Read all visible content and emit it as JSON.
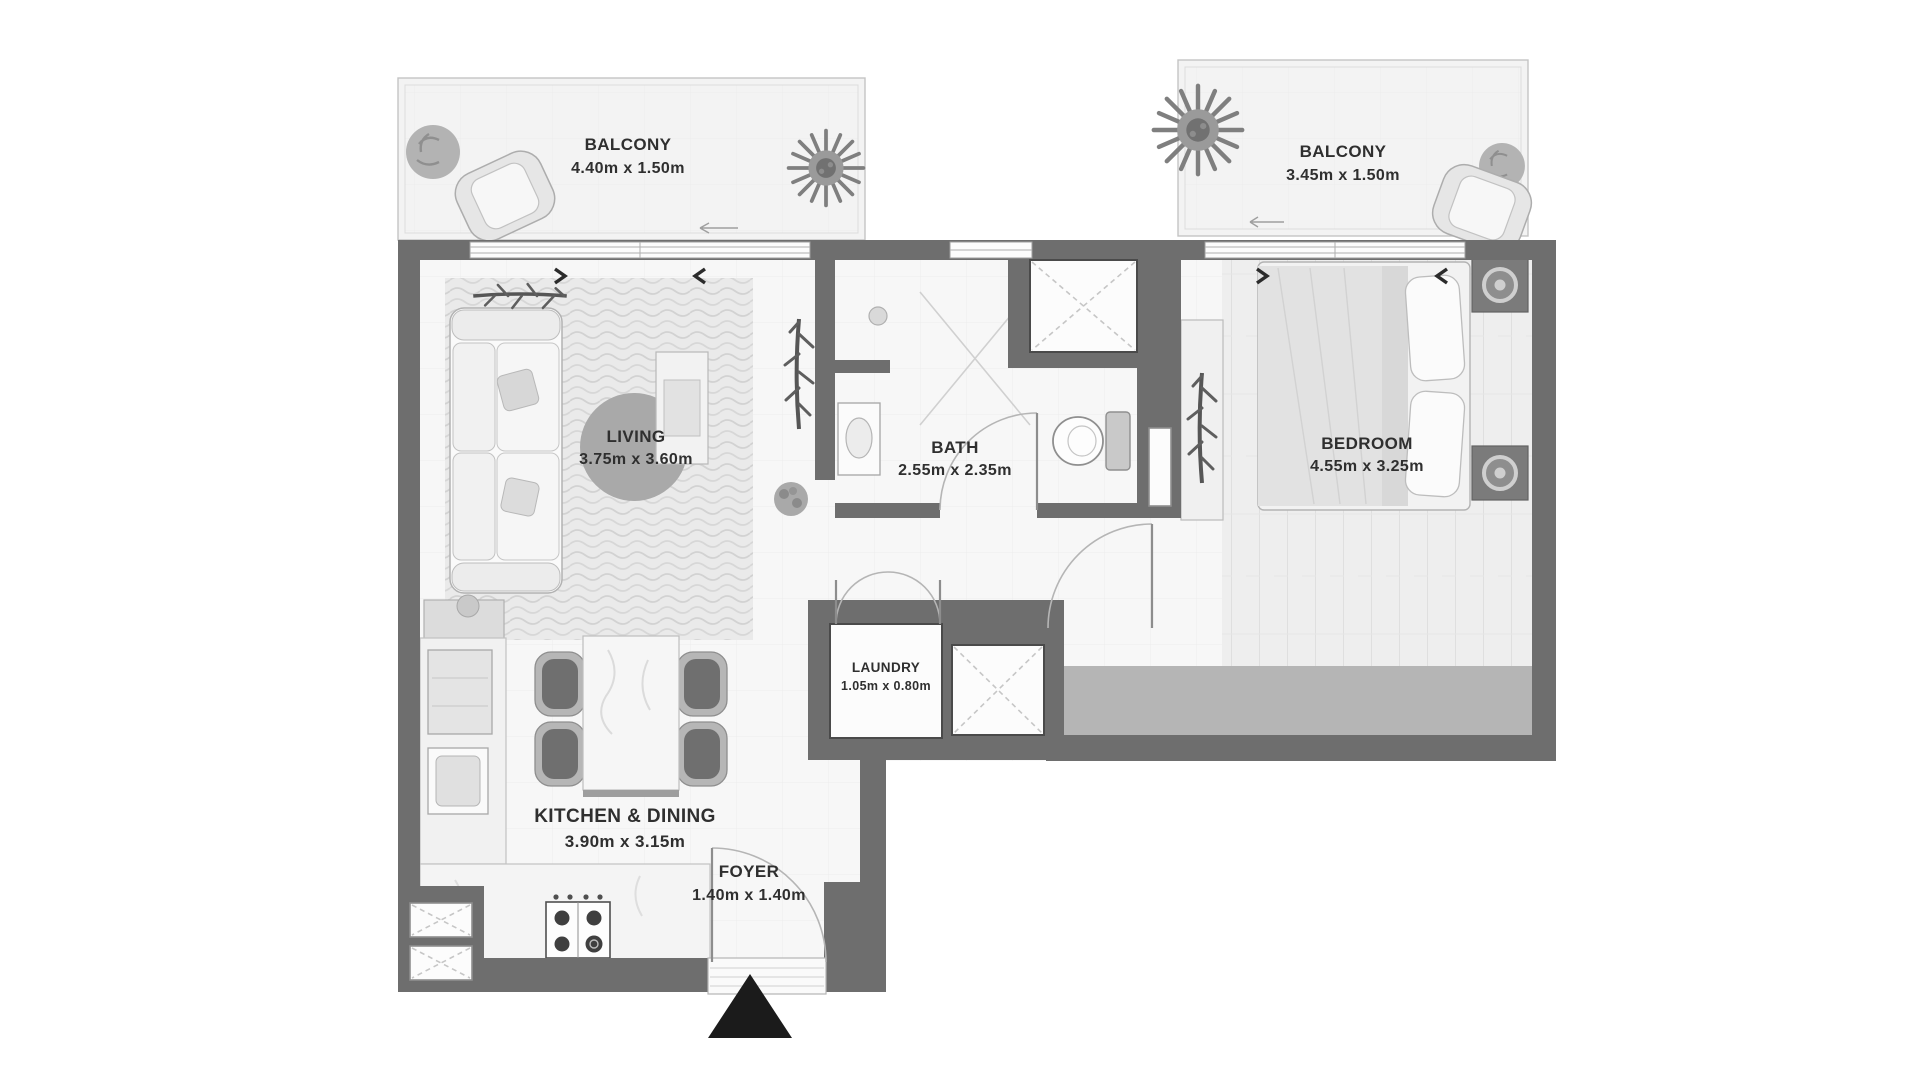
{
  "rooms": {
    "balcony_left": {
      "label": "BALCONY",
      "dims": "4.40m x 1.50m"
    },
    "balcony_right": {
      "label": "BALCONY",
      "dims": "3.45m x 1.50m"
    },
    "living": {
      "label": "LIVING",
      "dims": "3.75m x 3.60m"
    },
    "bath": {
      "label": "BATH",
      "dims": "2.55m x 2.35m"
    },
    "bedroom": {
      "label": "BEDROOM",
      "dims": "4.55m x 3.25m"
    },
    "laundry": {
      "label": "LAUNDRY",
      "dims": "1.05m x 0.80m"
    },
    "kitchen_dining": {
      "label": "KITCHEN & DINING",
      "dims": "3.90m x 3.15m"
    },
    "foyer": {
      "label": "FOYER",
      "dims": "1.40m x 1.40m"
    }
  },
  "colors": {
    "wall": "#6e6e6e",
    "floor": "#f7f7f7",
    "balcony": "#f3f3f3",
    "rug_circle": "#a9a9a9",
    "bedroom_band": "#b5b5b5",
    "entry_marker": "#1b1b1b",
    "text": "#2f2f2f"
  }
}
